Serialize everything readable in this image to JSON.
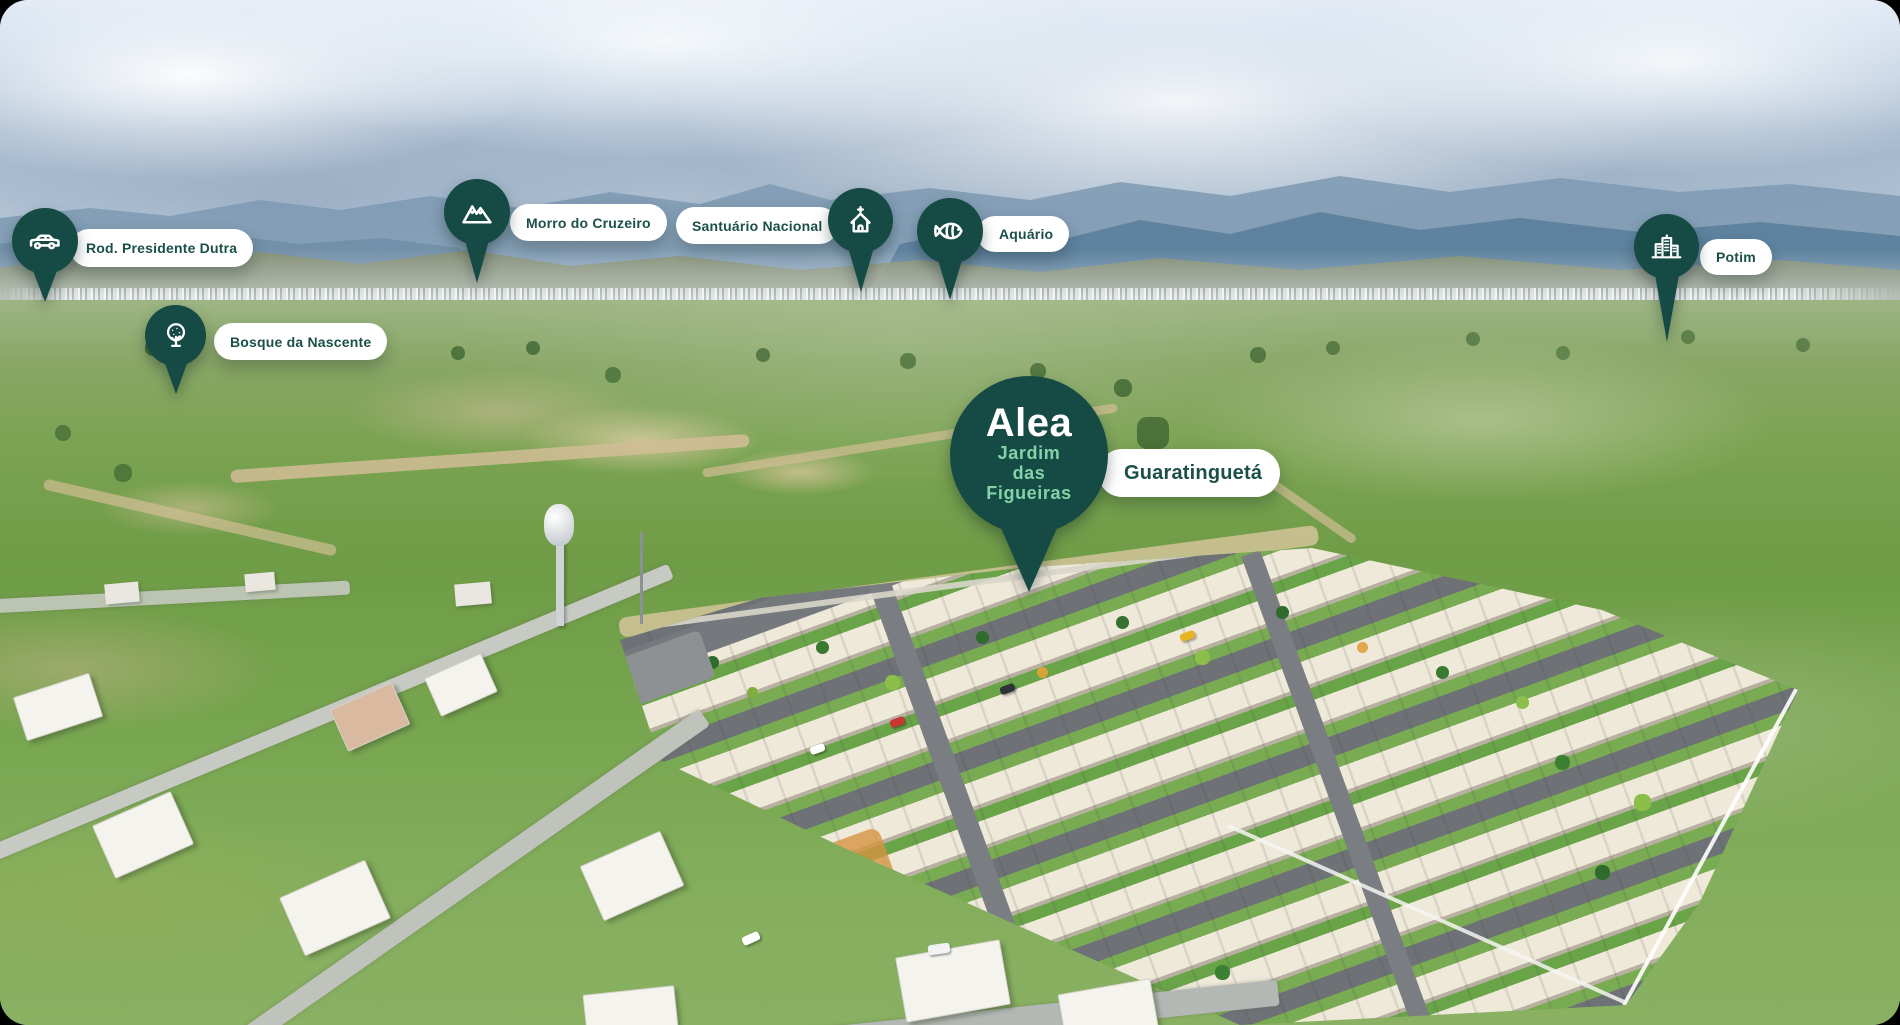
{
  "brand": {
    "logo": "Alea",
    "project_line1": "Jardim",
    "project_line2": "das",
    "project_line3": "Figueiras",
    "city_label": "Guaratinguetá"
  },
  "markers": [
    {
      "label": "Rod. Presidente Dutra",
      "icon": "car-icon"
    },
    {
      "label": "Bosque da Nascente",
      "icon": "tree-icon"
    },
    {
      "label": "Morro do Cruzeiro",
      "icon": "mountain-icon"
    },
    {
      "label": "Santuário Nacional",
      "icon": "church-icon"
    },
    {
      "label": "Aquário",
      "icon": "fish-icon"
    },
    {
      "label": "Potim",
      "icon": "city-buildings-icon"
    }
  ],
  "colors": {
    "pin_teal": "#164a44",
    "label_text_teal": "#1b5048",
    "mint_accent": "#84d3a8",
    "pill_background": "#ffffff"
  }
}
